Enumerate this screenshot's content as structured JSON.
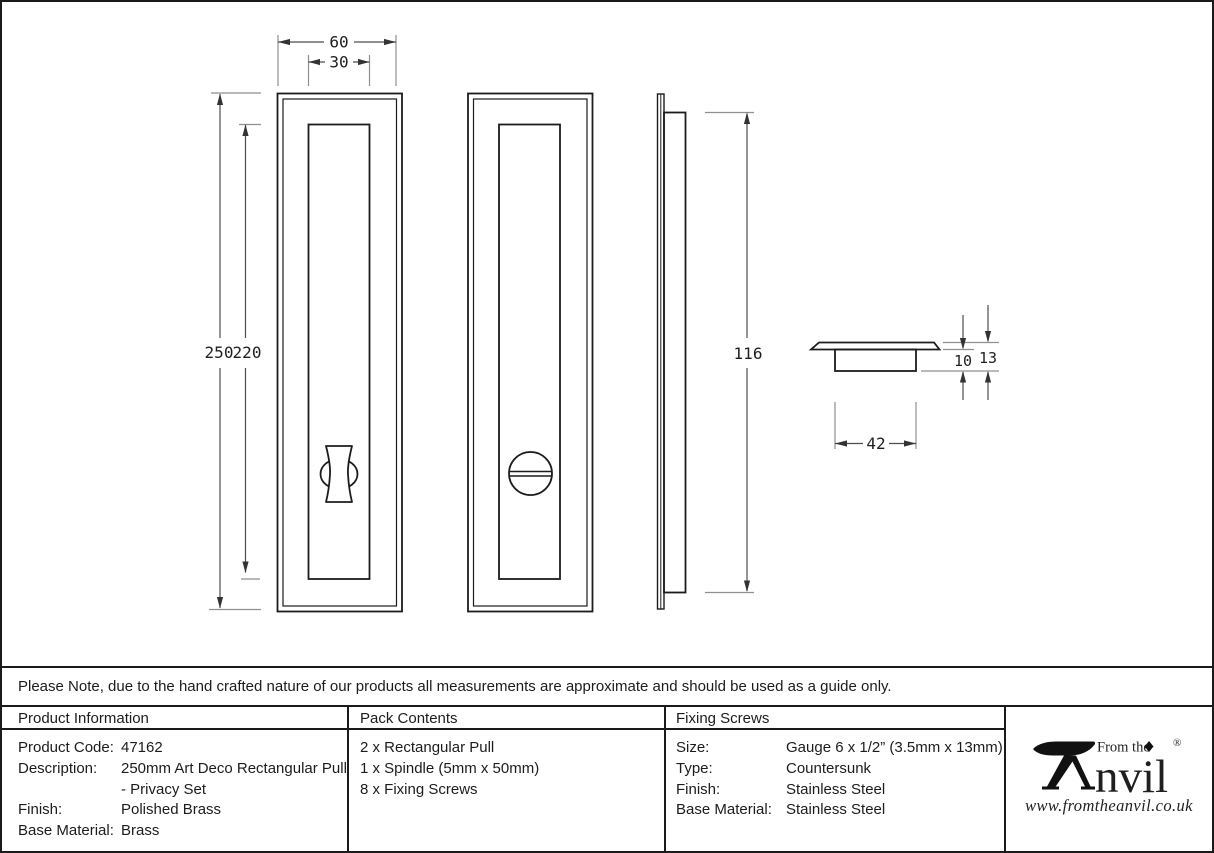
{
  "drawing": {
    "dims": {
      "plate_width": "60",
      "recess_width": "30",
      "plate_height": "250",
      "recess_height": "220",
      "side_body_height": "116",
      "cup_depth": "10",
      "overall_depth": "13",
      "cup_width": "42"
    }
  },
  "note": {
    "text": "Please Note, due to the hand crafted nature of our products all measurements are approximate and should be used as a guide only."
  },
  "table": {
    "product_info": {
      "header": "Product Information",
      "rows": [
        {
          "label": "Product Code:",
          "value": "47162"
        },
        {
          "label": "Description:",
          "value": "250mm Art Deco Rectangular Pull - Privacy Set"
        },
        {
          "label": "Finish:",
          "value": "Polished Brass"
        },
        {
          "label": "Base Material:",
          "value": "Brass"
        }
      ]
    },
    "pack_contents": {
      "header": "Pack Contents",
      "items": [
        "2 x Rectangular Pull",
        "1 x Spindle (5mm x 50mm)",
        "8 x Fixing Screws"
      ]
    },
    "fixing_screws": {
      "header": "Fixing Screws",
      "rows": [
        {
          "label": "Size:",
          "value": "Gauge 6 x 1/2” (3.5mm x 13mm)"
        },
        {
          "label": "Type:",
          "value": "Countersunk"
        },
        {
          "label": "Finish:",
          "value": "Stainless Steel"
        },
        {
          "label": "Base Material:",
          "value": "Stainless Steel"
        }
      ]
    }
  },
  "logo": {
    "brand_prefix": "From the",
    "brand_initial": "A",
    "brand_rest": "nvil",
    "registered": "®",
    "website": "www.fromtheanvil.co.uk"
  },
  "colors": {
    "outline": "#1c1c1c",
    "dimension": "#4d4d4d",
    "extension": "#8f8f8f",
    "background": "#ffffff"
  }
}
